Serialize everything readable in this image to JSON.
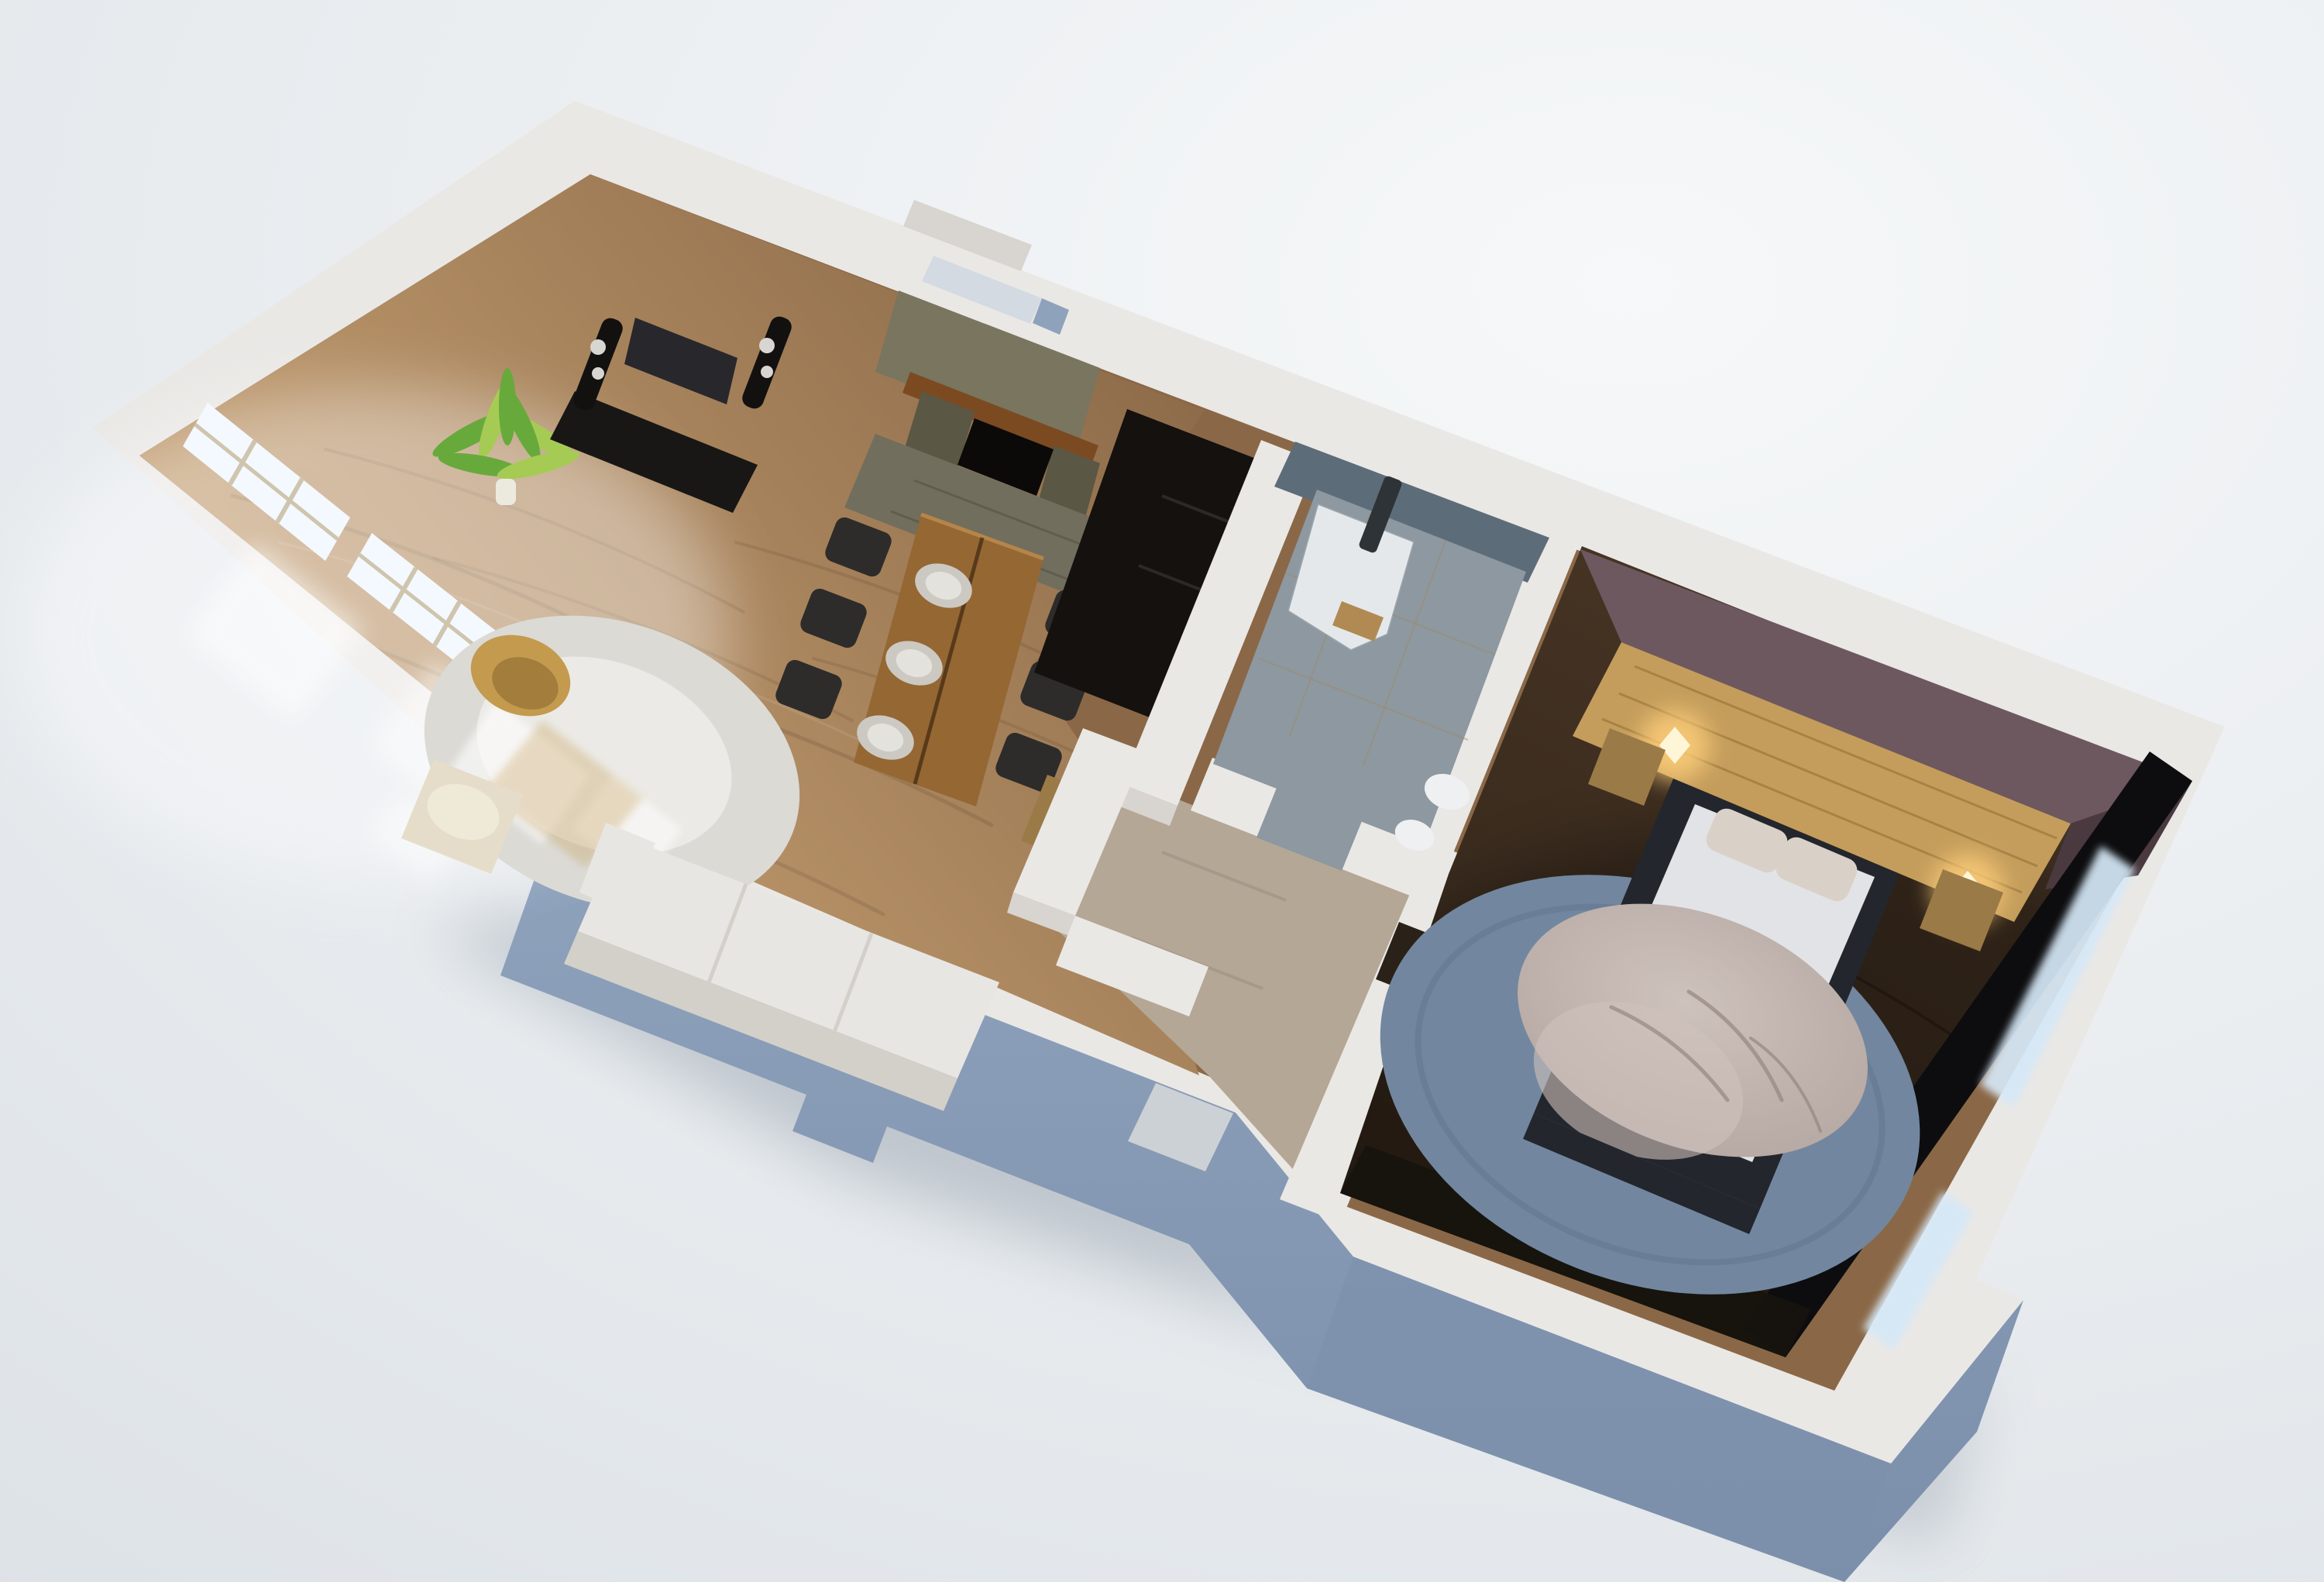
{
  "meta": {
    "description": "Photorealistic 3D isometric floor-plan rendering of a one-bedroom apartment, rotated on a light gray studio background",
    "view": "top-down axonometric, apartment tilted about 21 degrees",
    "background": "soft light-gray gradient, no text or UI elements visible"
  },
  "palette": {
    "bg_light": "#f6f8f9",
    "bg_dark": "#dde2e7",
    "drop_shadow": "#8c97a3",
    "wall_top": "#eae8e5",
    "wall_top_dim": "#d8d4cf",
    "wall_side": "#8ea2bc",
    "wall_side_dark": "#7b8fab",
    "window_glass": "#f3f9fe",
    "window_frame": "#cfc5ae",
    "light_pool": "#ffffff",
    "floor_light": "#d3ac7c",
    "floor_mid": "#8a6847",
    "grain_dark": "#3a2a1c",
    "hall_floor": "#b5a795",
    "door_floor": "#ccd1d5",
    "rug_white": "#dbdad5",
    "rug_white_hi": "#efeeea",
    "wicker": "#c49a4e",
    "wicker_dark": "#9c783a",
    "sofa": "#e8e6e2",
    "sofa_shade": "#d3d0ca",
    "armchair": "#e5ddca",
    "sheepskin": "#f0ead9",
    "table_wood": "#956733",
    "table_wood_hi": "#b5854a",
    "plank_line": "#4a2f14",
    "plate": "#ccc9c2",
    "plate_hi": "#e4e2dc",
    "chair_black": "#2d2c2a",
    "stone": "#79755f",
    "stone_dark": "#5a5744",
    "stone_cap": "#d3dae1",
    "mantel": "#7c4a21",
    "firebox": "#0b0a09",
    "hearth": "#716e5d",
    "cabinet_black": "#191715",
    "tv_screen": "#28282c",
    "speaker_black": "#131110",
    "speaker_dot": "#d8d6d2",
    "plant_green": "#68a93c",
    "plant_green_hi": "#a6cb54",
    "pot": "#eceade",
    "niche_black": "#14110f",
    "sideboard": "#9a7a46",
    "bath_wall": "#5d6c79",
    "bath_floor": "#8d98a1",
    "tile_line": "#a08a66",
    "glass_edge": "#f2f6f8",
    "shower_tray": "#e3e6e8",
    "shower_col": "#2e3338",
    "bench": "#b08a52",
    "toilet": "#eef0f2",
    "plum": "#6d5860",
    "plum_dark": "#4a3a40",
    "headboard": "#c49d5c",
    "headboard_dark": "#8f6c33",
    "sconce_glow": "#ffcf7a",
    "sconce_core": "#fff6d8",
    "bed_frame": "#23262c",
    "mattress": "#e2e3e6",
    "pillow": "#d9d1c8",
    "fur": "#b2a49e",
    "fur_hi": "#cec2bc",
    "rug_blue": "#72879f",
    "rug_blue_dark": "#5d7189",
    "bedroom_floor": "#4a3726",
    "bedroom_floor_dark": "#2e2218",
    "black_wall": "#0d0d0f",
    "window_slit": "#d5e8f7",
    "door_dark": "#2a2118"
  },
  "rooms": [
    {
      "id": "living-room",
      "label": "Living / dining room",
      "floor": "light oak parquet flooded with window daylight",
      "features": [
        "corner TV cabinet with flat-screen TV",
        "two black tower loudspeakers",
        "stacked-stone fireplace with timber mantel beam",
        "wooden dining table with six black chairs and three plates",
        "round white rug with sun patches",
        "rattan armchair",
        "white sofa against the lower wall",
        "cream armchair with sheepskin",
        "potted palm plant",
        "two large windows"
      ]
    },
    {
      "id": "hallway",
      "label": "Entry hall",
      "features": [
        "front-door opening in the lower wall",
        "white partition walls forming a closet nook",
        "wooden chest"
      ]
    },
    {
      "id": "bathroom",
      "label": "Bathroom",
      "features": [
        "corner glass shower with curved front",
        "dark shower column",
        "wooden bench",
        "toilet",
        "gray stone tile floor and walls"
      ]
    },
    {
      "id": "bedroom",
      "label": "Bedroom",
      "features": [
        "double bed with gray fur throw and two pillows",
        "full-width wood plank headboard",
        "two glowing wall sconces",
        "two wooden nightstands",
        "large round slate-blue rug",
        "dark plum walls",
        "bright window slits along the outer wall"
      ]
    }
  ]
}
